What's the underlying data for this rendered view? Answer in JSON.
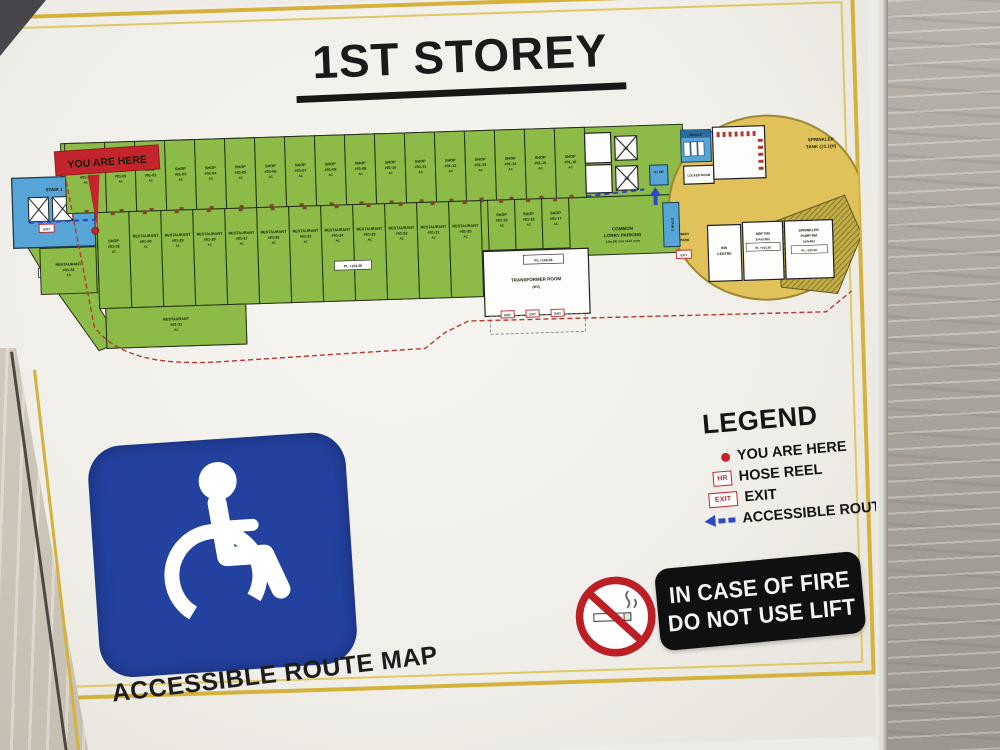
{
  "sign": {
    "title": "1ST STOREY",
    "caption": "ACCESSIBLE ROUTE MAP",
    "fire_notice": {
      "line1": "IN CASE OF FIRE",
      "line2": "DO NOT USE LIFT"
    },
    "legend": {
      "title": "LEGEND",
      "items": [
        {
          "icon": "red-dot",
          "label": "YOU ARE HERE"
        },
        {
          "icon": "hr-box",
          "icon_text": "HR",
          "label": "HOSE REEL"
        },
        {
          "icon": "exit-box",
          "icon_text": "EXIT",
          "label": "EXIT"
        },
        {
          "icon": "blue-arrow",
          "label": "ACCESSIBLE ROUTE"
        }
      ]
    }
  },
  "plan": {
    "you_are_here": "YOU ARE HERE",
    "stair_1": "STAIR 1",
    "stair_2": "STAIR 2",
    "lift_1": "L.1",
    "lift_2": "L.2",
    "ht_sw": "HT SW",
    "female": "FEMALE",
    "locker": "LOCKER ROOM",
    "exit": "EXIT",
    "pl_10436": "PL +104.36",
    "pl_10540": "PL +105.40",
    "transformer": {
      "line1": "TRANSFORMER ROOM",
      "line2": "(MV)"
    },
    "lorry": {
      "line1": "COMMON",
      "line2": "LORRY PARKING",
      "line3": "3.6m (H) max head room"
    },
    "carpark": {
      "line1": "COMMON",
      "line2": "CARPARK"
    },
    "tank": {
      "line1": "SPRINKLER",
      "line2": "TANK @1.1(H)"
    },
    "bin": {
      "line1": "BIN",
      "line2": "CENTRE"
    },
    "mdf": {
      "line1": "MDF RM",
      "line2": "3x4x3.5(h)"
    },
    "pump": {
      "line1": "SPRINKLER",
      "line2": "PUMP RM",
      "line3": "3x5x4(h)"
    },
    "green_hill": "GREEN HILL",
    "top_row": [
      {
        "type": "FOODCOURT",
        "num": "#01-34",
        "note": "AC",
        "w": 40
      },
      {
        "type": "SHOP",
        "num": "#01-01",
        "note": "AC"
      },
      {
        "type": "SHOP",
        "num": "#01-02",
        "note": "AC"
      },
      {
        "type": "SHOP",
        "num": "#01-03",
        "note": "AC"
      },
      {
        "type": "SHOP",
        "num": "#01-04",
        "note": "AC"
      },
      {
        "type": "SHOP",
        "num": "#01-05",
        "note": "AC"
      },
      {
        "type": "SHOP",
        "num": "#01-06",
        "note": "AC"
      },
      {
        "type": "SHOP",
        "num": "#01-07",
        "note": "AC"
      },
      {
        "type": "SHOP",
        "num": "#01-08",
        "note": "AC"
      },
      {
        "type": "SHOP",
        "num": "#01-09",
        "note": "AC"
      },
      {
        "type": "SHOP",
        "num": "#01-10",
        "note": "AC"
      },
      {
        "type": "SHOP",
        "num": "#01-11",
        "note": "AC"
      },
      {
        "type": "SHOP",
        "num": "#01-12",
        "note": "AC"
      },
      {
        "type": "SHOP",
        "num": "#01-13",
        "note": "AC"
      },
      {
        "type": "SHOP",
        "num": "#01-14",
        "note": "AC"
      },
      {
        "type": "SHOP",
        "num": "#01-15",
        "note": "AC"
      },
      {
        "type": "SHOP",
        "num": "#01-16",
        "note": "AC"
      }
    ],
    "inner_row": [
      {
        "type": "SHOP",
        "num": "#01-19",
        "note": "AC"
      },
      {
        "type": "SHOP",
        "num": "#01-18",
        "note": "AC"
      },
      {
        "type": "SHOP",
        "num": "#01-17",
        "note": "AC"
      }
    ],
    "bottom_row": [
      {
        "type": "RESTAURANT",
        "num": "#01-30",
        "note": "AC"
      },
      {
        "type": "RESTAURANT",
        "num": "#01-29",
        "note": "AC"
      },
      {
        "type": "RESTAURANT",
        "num": "#01-28",
        "note": "AC"
      },
      {
        "type": "RESTAURANT",
        "num": "#01-27",
        "note": "AC"
      },
      {
        "type": "RESTAURANT",
        "num": "#01-26",
        "note": "AC"
      },
      {
        "type": "RESTAURANT",
        "num": "#01-25",
        "note": "AC"
      },
      {
        "type": "RESTAURANT",
        "num": "#01-24",
        "note": "AC"
      },
      {
        "type": "RESTAURANT",
        "num": "#01-23",
        "note": "AC"
      },
      {
        "type": "RESTAURANT",
        "num": "#01-22",
        "note": "AC"
      },
      {
        "type": "RESTAURANT",
        "num": "#01-21",
        "note": "AC"
      },
      {
        "type": "RESTAURANT",
        "num": "#01-20",
        "note": "AC"
      }
    ],
    "left_units": [
      {
        "type": "RESTAURANT",
        "num": "#01-33",
        "note": "AC"
      },
      {
        "type": "SHOP",
        "num": "#01-32",
        "note": "AC"
      },
      {
        "type": "RESTAURANT",
        "num": "#01-31",
        "note": "AC"
      }
    ]
  },
  "colors": {
    "unit_green": "#8cbb47",
    "stair_blue": "#56a5d6",
    "carpark_yellow": "#e1c25a",
    "route_blue": "#2c49c8",
    "route_red": "#b23a2e",
    "accent_red": "#c4242b",
    "isa_blue": "#2342a0",
    "gold_frame": "#d5b23c"
  }
}
